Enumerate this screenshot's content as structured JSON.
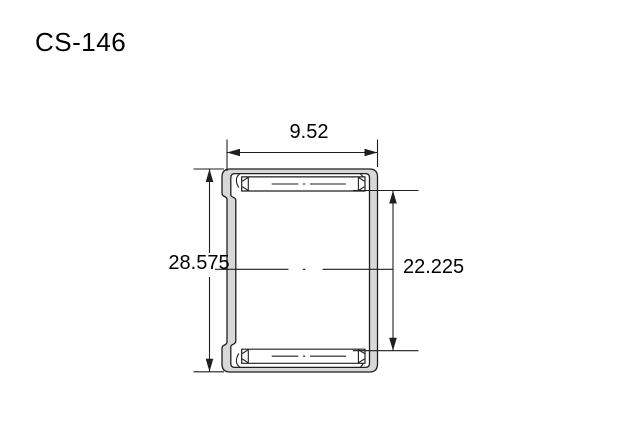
{
  "title": "CS-146",
  "dimensions": {
    "width": "9.52",
    "outer_height": "28.575",
    "bore_height": "22.225"
  },
  "colors": {
    "background": "#ffffff",
    "line": "#1f1f1f",
    "metal_fill": "#d8d8d8",
    "text": "#000000"
  }
}
